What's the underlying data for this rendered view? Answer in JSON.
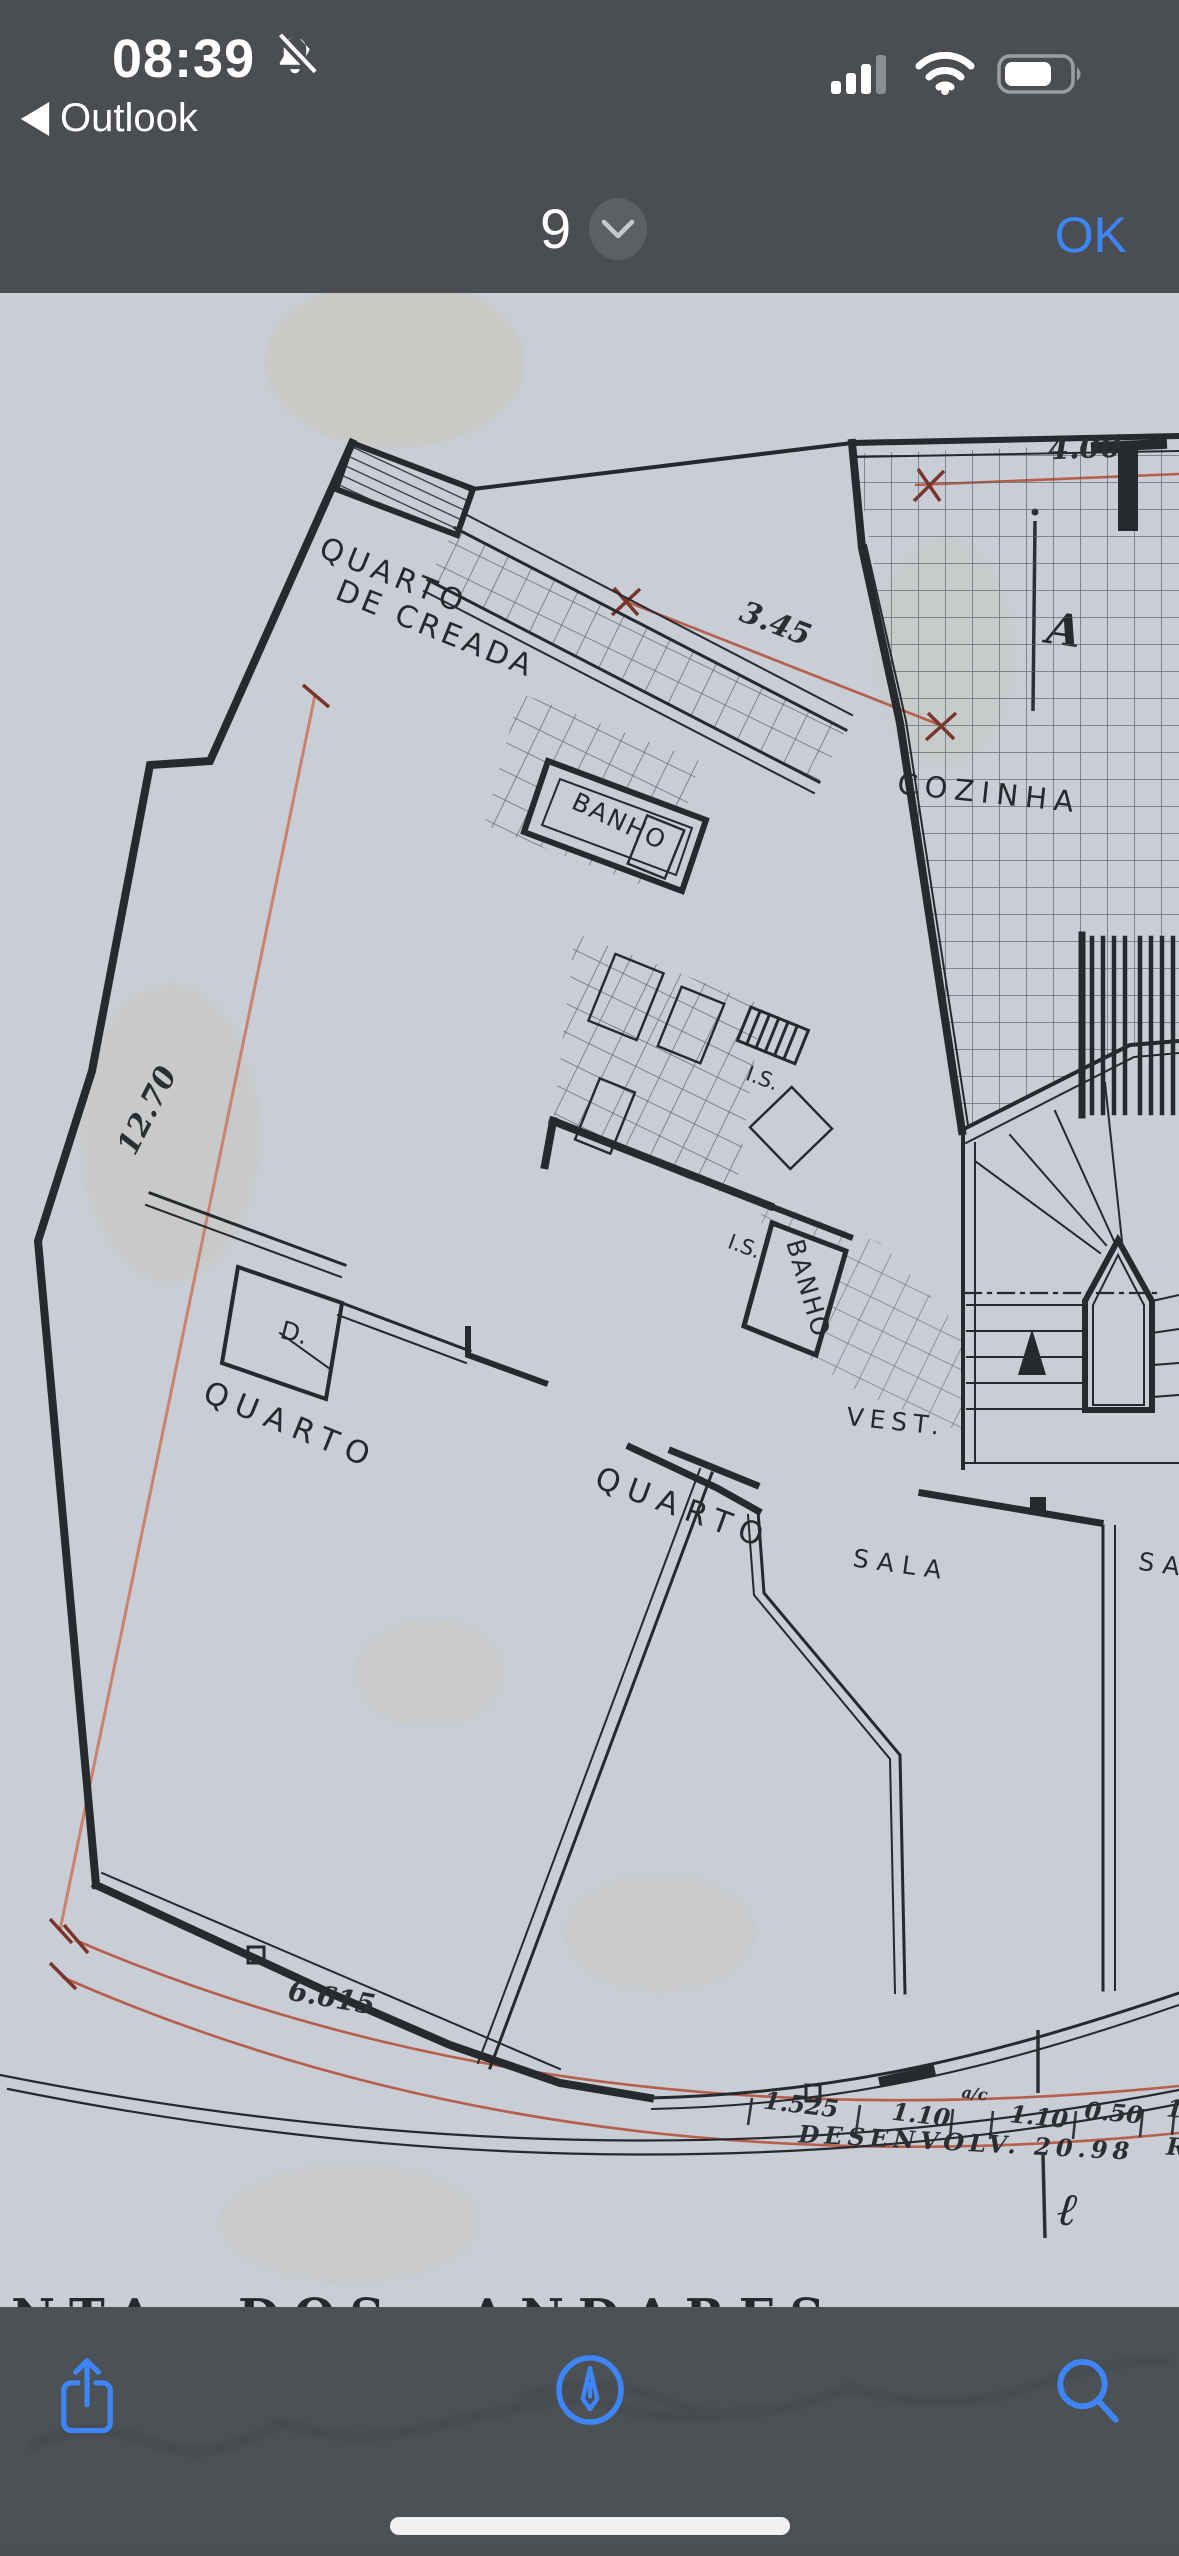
{
  "status_bar": {
    "time": "08:39",
    "back_app": "Outlook",
    "bell_icon": "bell-slash-icon",
    "signal_bars_filled": "3 of 4",
    "wifi_icon": "wifi-icon",
    "battery_level": "0.62"
  },
  "nav_bar": {
    "page_indicator": "9",
    "chevron_icon": "chevron-down-icon",
    "confirm_label": "OK"
  },
  "plan": {
    "title": "PLANTA DOS ANDARES",
    "rooms": {
      "maid_room_line1": "QUARTO",
      "maid_room_line2": "DE CREADA",
      "bath1": "BANHO",
      "bath2": "BANHO",
      "kitchen": "COZINHA",
      "wc1": "I.S.",
      "wc2": "I.S.",
      "closet": "D.",
      "bedroom_left": "QUARTO",
      "bedroom_mid": "QUARTO",
      "vestibule": "VEST.",
      "living": "SALA",
      "living2": "SA"
    },
    "dimensions": {
      "top": "4.00",
      "upper_diag": "3.45",
      "left_side": "12.70",
      "bottom_left": "6.615",
      "seg1": "1.525",
      "seg2": "1.10",
      "seg_note": "a/c",
      "seg3": "1.10",
      "seg4": "0.50",
      "seg5": "1",
      "development": "DESENVOLV. 20.98",
      "edge_letter": "R"
    },
    "axis": {
      "top_letter": "A",
      "bottom_letter": "ℓ"
    }
  },
  "toolbar": {
    "share_icon": "share-icon",
    "markup_icon": "markup-pen-icon",
    "search_icon": "search-icon"
  },
  "colors": {
    "chrome_bg": "#4a4e52",
    "accent_blue": "#3e86f7",
    "paper": "#c8cdd6",
    "ink": "#26292d",
    "dim_red": "#b65f4d",
    "dim_red_light": "#c9836e"
  }
}
